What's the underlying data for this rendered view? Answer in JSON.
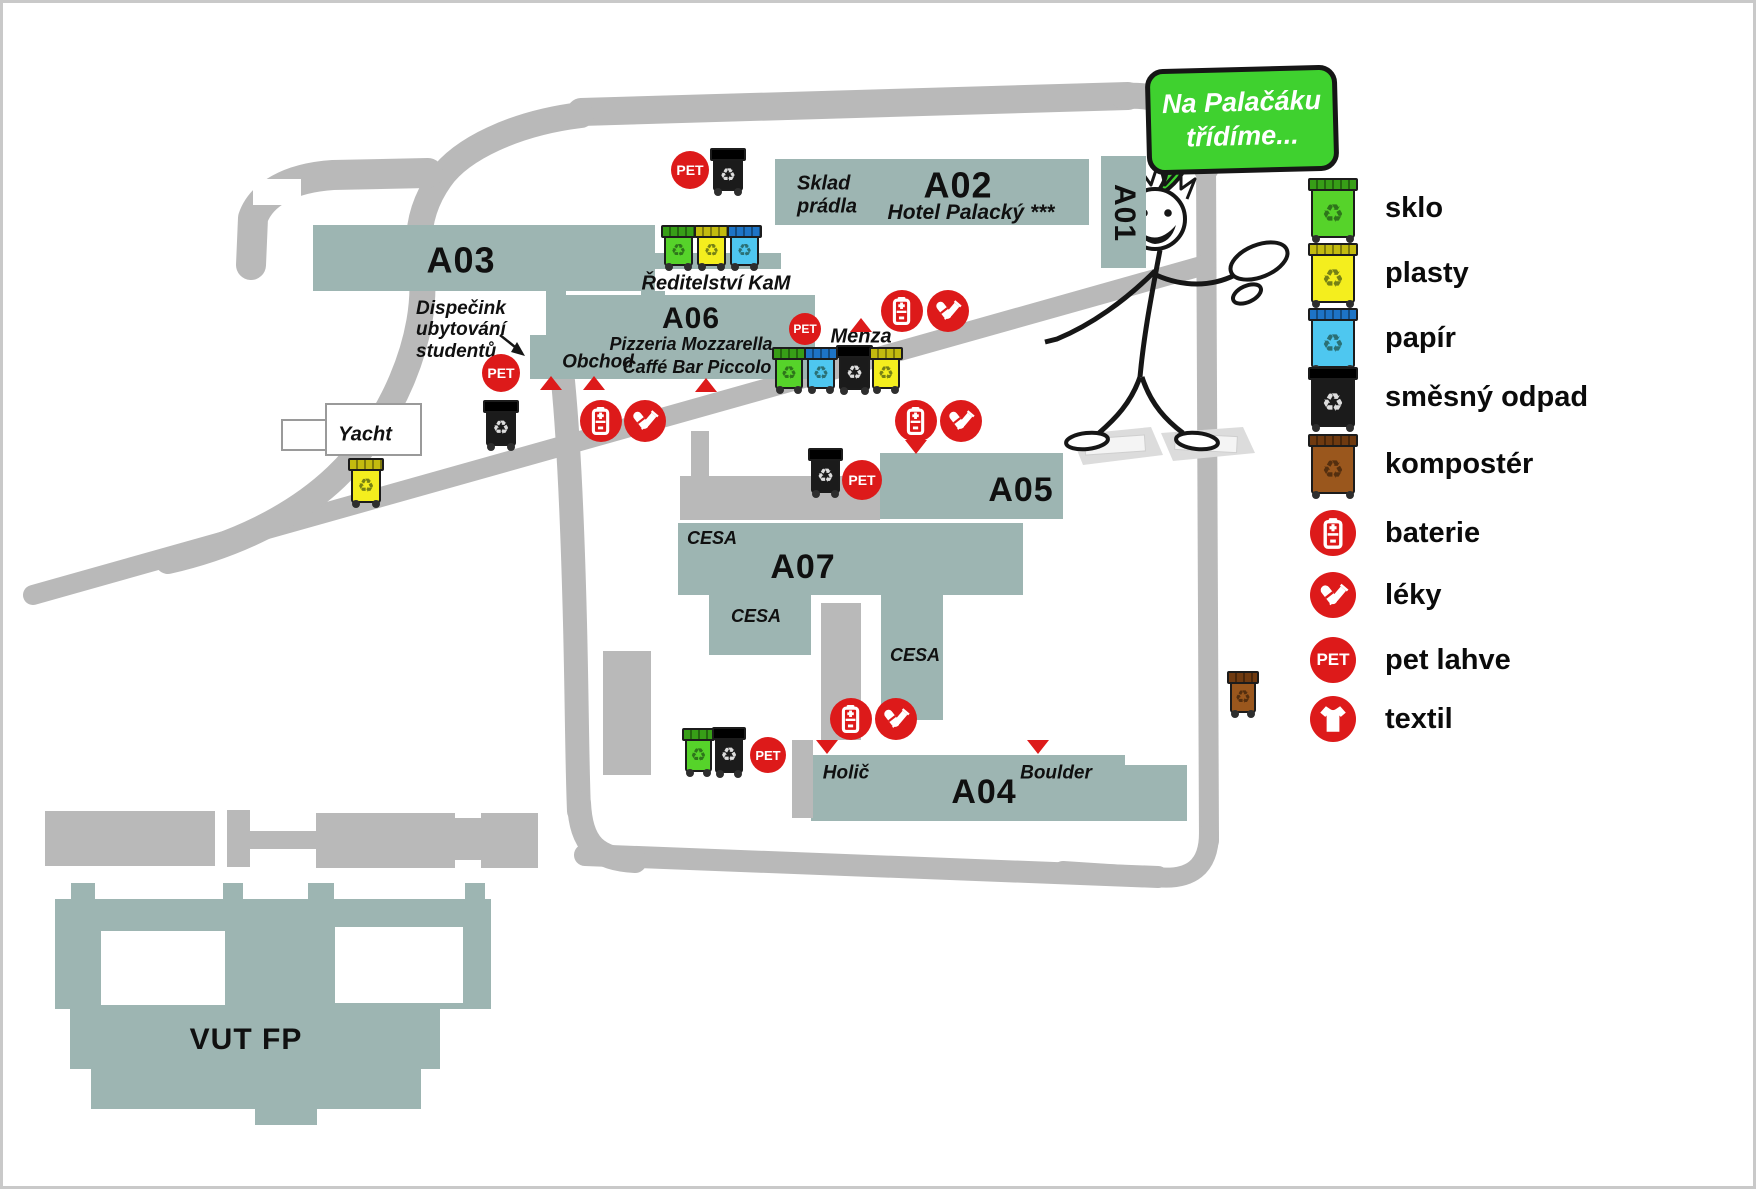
{
  "bubble": {
    "line1": "Na Palačáku",
    "line2": "třídíme..."
  },
  "colors": {
    "building": "#9db5b2",
    "road": "#b9b9b9",
    "red": "#dd1a1a",
    "bubble_green": "#3fd12f",
    "bins": {
      "green": [
        "#56d32a",
        "#379e17"
      ],
      "yellow": [
        "#f4ee1e",
        "#c3bb0f"
      ],
      "blue": [
        "#4ec7f0",
        "#1d74c6"
      ],
      "black": [
        "#1b1b1b",
        "#000000"
      ],
      "brown": [
        "#9a571d",
        "#6f3a10"
      ]
    }
  },
  "legend": {
    "items": [
      {
        "icon": "bin-green",
        "label": "sklo",
        "y": 205
      },
      {
        "icon": "bin-yellow",
        "label": "plasty",
        "y": 270
      },
      {
        "icon": "bin-blue",
        "label": "papír",
        "y": 335
      },
      {
        "icon": "bin-black",
        "label": "směsný odpad",
        "y": 394
      },
      {
        "icon": "bin-brown",
        "label": "kompostér",
        "y": 461
      },
      {
        "icon": "battery",
        "label": "baterie",
        "y": 530
      },
      {
        "icon": "medicine",
        "label": "léky",
        "y": 592
      },
      {
        "icon": "pet",
        "label": "pet lahve",
        "y": 657
      },
      {
        "icon": "textile",
        "label": "textil",
        "y": 716
      }
    ]
  },
  "map": {
    "pet_text": "PET",
    "shapes": [
      {
        "name": "building-A02",
        "fill": "teal",
        "x": 772,
        "y": 156,
        "w": 314,
        "h": 66
      },
      {
        "name": "building-A01",
        "fill": "teal",
        "x": 1098,
        "y": 153,
        "w": 45,
        "h": 112
      },
      {
        "name": "building-A03",
        "fill": "teal",
        "x": 310,
        "y": 222,
        "w": 342,
        "h": 66
      },
      {
        "name": "building-A06-topband",
        "fill": "teal",
        "x": 645,
        "y": 250,
        "w": 133,
        "h": 16
      },
      {
        "name": "building-A06-conn1",
        "fill": "teal",
        "x": 543,
        "y": 288,
        "w": 20,
        "h": 46
      },
      {
        "name": "building-A06-conn2",
        "fill": "teal",
        "x": 638,
        "y": 288,
        "w": 24,
        "h": 46
      },
      {
        "name": "building-A06",
        "fill": "teal",
        "x": 558,
        "y": 292,
        "w": 254,
        "h": 62
      },
      {
        "name": "building-A06-obchod-wing",
        "fill": "teal",
        "x": 527,
        "y": 332,
        "w": 285,
        "h": 44
      },
      {
        "name": "building-A05",
        "fill": "teal",
        "x": 877,
        "y": 450,
        "w": 183,
        "h": 66
      },
      {
        "name": "building-A07-a",
        "fill": "teal",
        "x": 675,
        "y": 520,
        "w": 202,
        "h": 72
      },
      {
        "name": "building-A07-c",
        "fill": "teal",
        "x": 877,
        "y": 520,
        "w": 143,
        "h": 72
      },
      {
        "name": "building-A07-b",
        "fill": "teal",
        "x": 706,
        "y": 592,
        "w": 102,
        "h": 60
      },
      {
        "name": "building-A07-d",
        "fill": "teal",
        "x": 878,
        "y": 592,
        "w": 62,
        "h": 125
      },
      {
        "name": "building-A04",
        "fill": "teal",
        "x": 808,
        "y": 752,
        "w": 314,
        "h": 66
      },
      {
        "name": "building-A04-step",
        "fill": "teal",
        "x": 1122,
        "y": 762,
        "w": 62,
        "h": 56
      },
      {
        "name": "building-VUTFP-bump",
        "fill": "teal",
        "x": 68,
        "y": 880,
        "w": 24,
        "h": 18
      },
      {
        "name": "building-VUTFP-bump",
        "fill": "teal",
        "x": 220,
        "y": 880,
        "w": 20,
        "h": 18
      },
      {
        "name": "building-VUTFP-bump",
        "fill": "teal",
        "x": 305,
        "y": 880,
        "w": 26,
        "h": 18
      },
      {
        "name": "building-VUTFP-bump",
        "fill": "teal",
        "x": 462,
        "y": 880,
        "w": 20,
        "h": 18
      },
      {
        "name": "building-VUTFP-main",
        "fill": "teal",
        "x": 52,
        "y": 896,
        "w": 436,
        "h": 110
      },
      {
        "name": "building-VUTFP-mid",
        "fill": "teal",
        "x": 67,
        "y": 1006,
        "w": 370,
        "h": 60
      },
      {
        "name": "building-VUTFP-low",
        "fill": "teal",
        "x": 88,
        "y": 1066,
        "w": 330,
        "h": 40
      },
      {
        "name": "building-VUTFP-foot",
        "fill": "teal",
        "x": 252,
        "y": 1106,
        "w": 62,
        "h": 16
      },
      {
        "name": "courtyard",
        "fill": "white",
        "x": 98,
        "y": 928,
        "w": 124,
        "h": 74
      },
      {
        "name": "courtyard",
        "fill": "white",
        "x": 332,
        "y": 924,
        "w": 128,
        "h": 76
      },
      {
        "name": "building-yacht-annex",
        "fill": "white",
        "stroke": true,
        "x": 278,
        "y": 416,
        "w": 44,
        "h": 28
      },
      {
        "name": "building-yacht",
        "fill": "white",
        "stroke": true,
        "x": 322,
        "y": 400,
        "w": 93,
        "h": 49
      },
      {
        "name": "plaza",
        "fill": "gray",
        "x": 677,
        "y": 473,
        "w": 200,
        "h": 44
      },
      {
        "name": "plaza-connector",
        "fill": "gray",
        "x": 688,
        "y": 428,
        "w": 18,
        "h": 47
      },
      {
        "name": "footpath",
        "fill": "gray",
        "x": 600,
        "y": 648,
        "w": 48,
        "h": 124
      },
      {
        "name": "footpath",
        "fill": "gray",
        "x": 818,
        "y": 600,
        "w": 40,
        "h": 137
      },
      {
        "name": "footpath",
        "fill": "gray",
        "x": 789,
        "y": 737,
        "w": 21,
        "h": 78
      },
      {
        "name": "road-bar",
        "fill": "gray",
        "x": 42,
        "y": 808,
        "w": 170,
        "h": 55
      },
      {
        "name": "road-bar",
        "fill": "gray",
        "x": 224,
        "y": 807,
        "w": 23,
        "h": 57
      },
      {
        "name": "road-bar",
        "fill": "gray",
        "x": 247,
        "y": 828,
        "w": 66,
        "h": 18
      },
      {
        "name": "road-bar",
        "fill": "gray",
        "x": 313,
        "y": 810,
        "w": 139,
        "h": 55
      },
      {
        "name": "road-bar",
        "fill": "gray",
        "x": 452,
        "y": 815,
        "w": 26,
        "h": 42
      },
      {
        "name": "road-bar",
        "fill": "gray",
        "x": 478,
        "y": 810,
        "w": 57,
        "h": 55
      }
    ],
    "labels": [
      {
        "text": "A02",
        "x": 955,
        "y": 183,
        "kind": "code",
        "size": 36
      },
      {
        "text": "Hotel Palacký ***",
        "x": 968,
        "y": 210,
        "kind": "it",
        "size": 21
      },
      {
        "text": "Sklad\nprádla",
        "x": 794,
        "y": 192,
        "kind": "it",
        "size": 20,
        "align": "left"
      },
      {
        "text": "A01",
        "x": 1121,
        "y": 210,
        "kind": "code",
        "size": 30,
        "rotate": 90
      },
      {
        "text": "A03",
        "x": 458,
        "y": 258,
        "kind": "code",
        "size": 36
      },
      {
        "text": "Ředitelství KaM",
        "x": 713,
        "y": 281,
        "kind": "it",
        "size": 20
      },
      {
        "text": "A06",
        "x": 688,
        "y": 316,
        "kind": "code",
        "size": 30
      },
      {
        "text": "Pizzeria Mozzarella",
        "x": 688,
        "y": 341,
        "kind": "it",
        "size": 18
      },
      {
        "text": "Caffé Bar Piccolo",
        "x": 694,
        "y": 364,
        "kind": "it",
        "size": 18
      },
      {
        "text": "Obchod",
        "x": 595,
        "y": 359,
        "kind": "it",
        "size": 19
      },
      {
        "text": "Dispečink\nubytování\nstudentů",
        "x": 413,
        "y": 327,
        "kind": "it",
        "size": 19,
        "align": "left"
      },
      {
        "text": "Menza",
        "x": 858,
        "y": 334,
        "kind": "it",
        "size": 20
      },
      {
        "text": "Yacht",
        "x": 362,
        "y": 432,
        "kind": "it",
        "size": 20
      },
      {
        "text": "A05",
        "x": 1018,
        "y": 487,
        "kind": "code",
        "size": 34
      },
      {
        "text": "CESA",
        "x": 709,
        "y": 535,
        "kind": "it",
        "size": 18
      },
      {
        "text": "A07",
        "x": 800,
        "y": 564,
        "kind": "code",
        "size": 34
      },
      {
        "text": "CESA",
        "x": 753,
        "y": 613,
        "kind": "it",
        "size": 18
      },
      {
        "text": "CESA",
        "x": 912,
        "y": 652,
        "kind": "it",
        "size": 18
      },
      {
        "text": "Holič",
        "x": 843,
        "y": 770,
        "kind": "it",
        "size": 19
      },
      {
        "text": "Boulder",
        "x": 1053,
        "y": 770,
        "kind": "it",
        "size": 19
      },
      {
        "text": "A04",
        "x": 981,
        "y": 789,
        "kind": "code",
        "size": 34
      },
      {
        "text": "VUT FP",
        "x": 243,
        "y": 1037,
        "kind": "code",
        "size": 30
      }
    ],
    "markers": [
      {
        "type": "pet",
        "x": 687,
        "y": 167,
        "r": 19
      },
      {
        "type": "pet",
        "x": 498,
        "y": 370,
        "r": 19
      },
      {
        "type": "pet",
        "x": 802,
        "y": 326,
        "r": 16
      },
      {
        "type": "pet",
        "x": 859,
        "y": 477,
        "r": 20
      },
      {
        "type": "pet",
        "x": 765,
        "y": 752,
        "r": 18
      },
      {
        "type": "battery",
        "x": 899,
        "y": 308,
        "r": 21
      },
      {
        "type": "battery",
        "x": 598,
        "y": 418,
        "r": 21
      },
      {
        "type": "battery",
        "x": 913,
        "y": 418,
        "r": 21
      },
      {
        "type": "battery",
        "x": 848,
        "y": 716,
        "r": 21
      },
      {
        "type": "medicine",
        "x": 945,
        "y": 308,
        "r": 21
      },
      {
        "type": "medicine",
        "x": 642,
        "y": 418,
        "r": 21
      },
      {
        "type": "medicine",
        "x": 958,
        "y": 418,
        "r": 21
      },
      {
        "type": "medicine",
        "x": 893,
        "y": 716,
        "r": 21
      },
      {
        "type": "triangle-up",
        "x": 548,
        "y": 380
      },
      {
        "type": "triangle-up",
        "x": 591,
        "y": 380
      },
      {
        "type": "triangle-up",
        "x": 703,
        "y": 382
      },
      {
        "type": "triangle-up",
        "x": 858,
        "y": 322
      },
      {
        "type": "triangle-down",
        "x": 913,
        "y": 444
      },
      {
        "type": "triangle-down",
        "x": 824,
        "y": 744
      },
      {
        "type": "triangle-down",
        "x": 1035,
        "y": 744
      }
    ],
    "bins": [
      {
        "color": "green",
        "x": 661,
        "y": 222,
        "w": 29,
        "h": 41
      },
      {
        "color": "yellow",
        "x": 694,
        "y": 222,
        "w": 29,
        "h": 41
      },
      {
        "color": "blue",
        "x": 727,
        "y": 222,
        "w": 29,
        "h": 41
      },
      {
        "color": "black",
        "x": 710,
        "y": 145,
        "w": 30,
        "h": 43
      },
      {
        "color": "green",
        "x": 772,
        "y": 344,
        "w": 28,
        "h": 42
      },
      {
        "color": "blue",
        "x": 804,
        "y": 344,
        "w": 28,
        "h": 42
      },
      {
        "color": "black",
        "x": 836,
        "y": 342,
        "w": 31,
        "h": 45
      },
      {
        "color": "yellow",
        "x": 869,
        "y": 344,
        "w": 28,
        "h": 42
      },
      {
        "color": "black",
        "x": 483,
        "y": 397,
        "w": 30,
        "h": 46
      },
      {
        "color": "yellow",
        "x": 348,
        "y": 455,
        "w": 30,
        "h": 45
      },
      {
        "color": "black",
        "x": 808,
        "y": 445,
        "w": 29,
        "h": 45
      },
      {
        "color": "green",
        "x": 682,
        "y": 725,
        "w": 27,
        "h": 44
      },
      {
        "color": "black",
        "x": 712,
        "y": 724,
        "w": 28,
        "h": 46
      },
      {
        "color": "brown",
        "x": 1227,
        "y": 668,
        "w": 26,
        "h": 42
      }
    ]
  }
}
